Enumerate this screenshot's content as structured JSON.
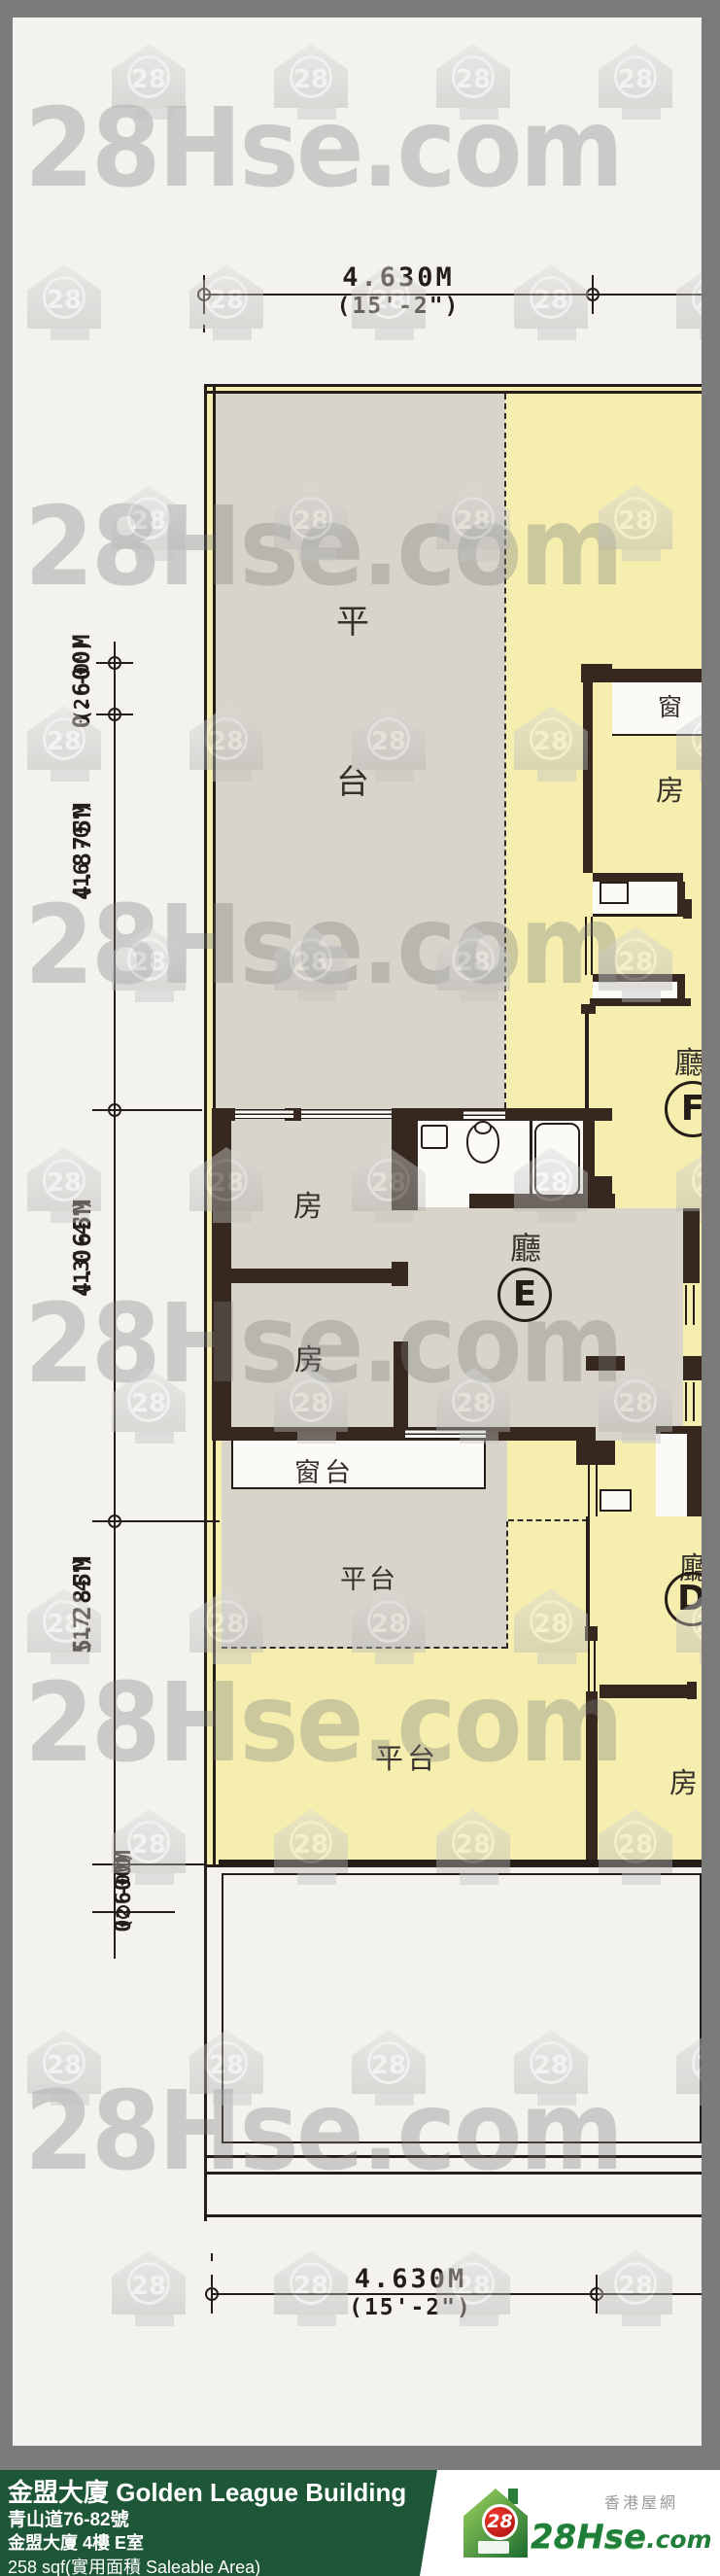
{
  "watermark": {
    "text": "28Hse.com",
    "icon_text": "28"
  },
  "dimensions": {
    "top": {
      "value": "4.630M",
      "imperial": "(15'-2\")"
    },
    "bottom": {
      "value": "4.630M",
      "imperial": "(15'-2\")"
    },
    "left": [
      {
        "value": "0.600M",
        "imperial": "(2'-0\")"
      },
      {
        "value": "4.875M",
        "imperial": "(16'-0\")"
      },
      {
        "value": "4.065M",
        "imperial": "(13'-4\")"
      },
      {
        "value": "5.285M",
        "imperial": "(17'-4\")"
      },
      {
        "value": "0.600M",
        "imperial": "(2'-0\")"
      }
    ]
  },
  "plan": {
    "labels": {
      "terrace_char_1": "平",
      "terrace_char_2": "台",
      "terrace": "平台",
      "room": "房",
      "hall": "廳",
      "bay_window": "窗台",
      "window": "窗"
    },
    "units": {
      "e": "E",
      "f": "F",
      "d": "D"
    },
    "colors": {
      "floor_gray": "#d8d4c9",
      "floor_yellow": "#f5eeae",
      "wall": "#36281f"
    }
  },
  "footer": {
    "title": "金盟大廈 Golden League Building",
    "address": "青山道76-82號",
    "unit": "金盟大廈 4樓 E室",
    "area": "258 sqf(實用面積 Saleable Area)",
    "bar_color": "#1d5737"
  },
  "logo": {
    "badge": "28",
    "brand": "28Hse",
    "brand_tld": ".com",
    "tagline": "香港屋網",
    "brand_color": "#1f7e39"
  }
}
